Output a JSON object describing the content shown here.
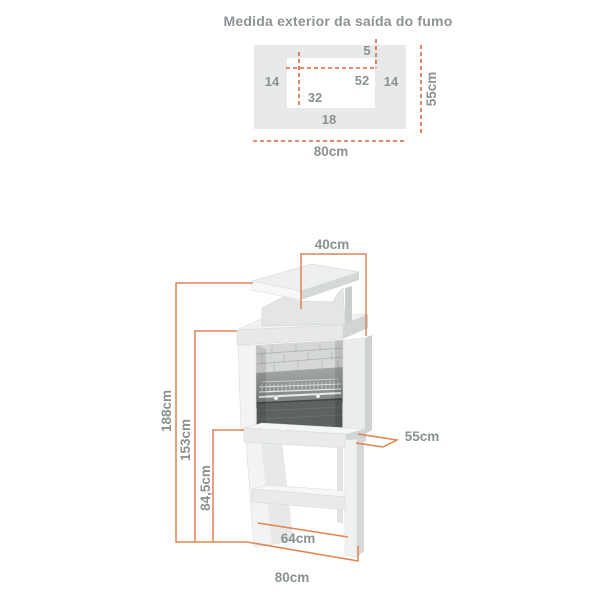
{
  "colors": {
    "dimension_line": "#E08450",
    "dashed_line": "#DC6640",
    "label_text": "#8B9193",
    "panel_gray": "#E8E9E9"
  },
  "smoke_outlet_top_view": {
    "title": "Medida exterior da saída do fumo",
    "labels": {
      "gap_top": "5",
      "wall_left": "14",
      "opening_width": "52",
      "wall_right": "14",
      "opening_offset": "32",
      "ledge_bottom": "18",
      "overall_depth": "55cm",
      "overall_width": "80cm"
    }
  },
  "barbecue_view": {
    "labels": {
      "chimney_width": "40cm",
      "total_height": "188cm",
      "hood_height": "153cm",
      "worktop_height": "84,5cm",
      "depth": "55cm",
      "shelf_width": "64cm",
      "base_width": "80cm"
    }
  }
}
